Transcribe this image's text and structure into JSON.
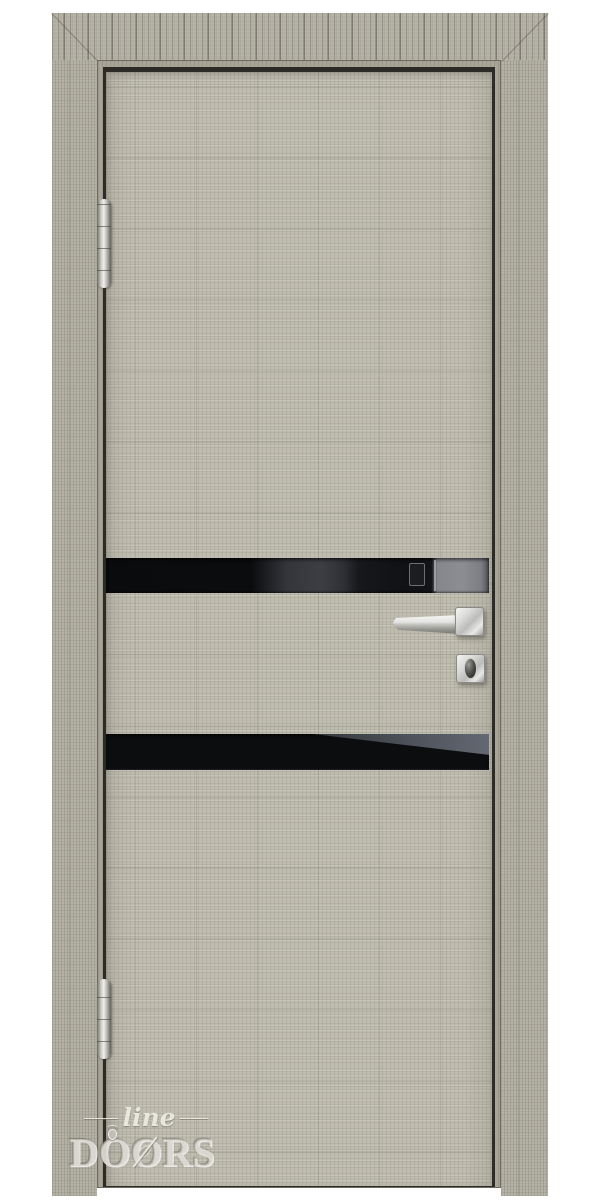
{
  "photo": {
    "description": "Product photograph of an interior door: gray crosscut-oak wood finish, two horizontal black glass inserts, chrome lever handle with thumbturn lock, two chrome barrel hinges, on a white background",
    "brand_logo": {
      "script": "line",
      "word": "DOORS",
      "letters": [
        "D",
        "O",
        "O",
        "R",
        "S"
      ]
    },
    "colors": {
      "background": "#ffffff",
      "wood_slab": "#bfbcb0",
      "wood_casing": "#b3b0a4",
      "frame_stop": "#a8a598",
      "gap_shadow": "#2c2b26",
      "glass_black": "#0b0c0e",
      "glass_reflection": "#87898e",
      "chrome_light": "#f0efeb",
      "chrome_dark": "#6f6e68",
      "watermark": "#e8e6dd"
    }
  }
}
